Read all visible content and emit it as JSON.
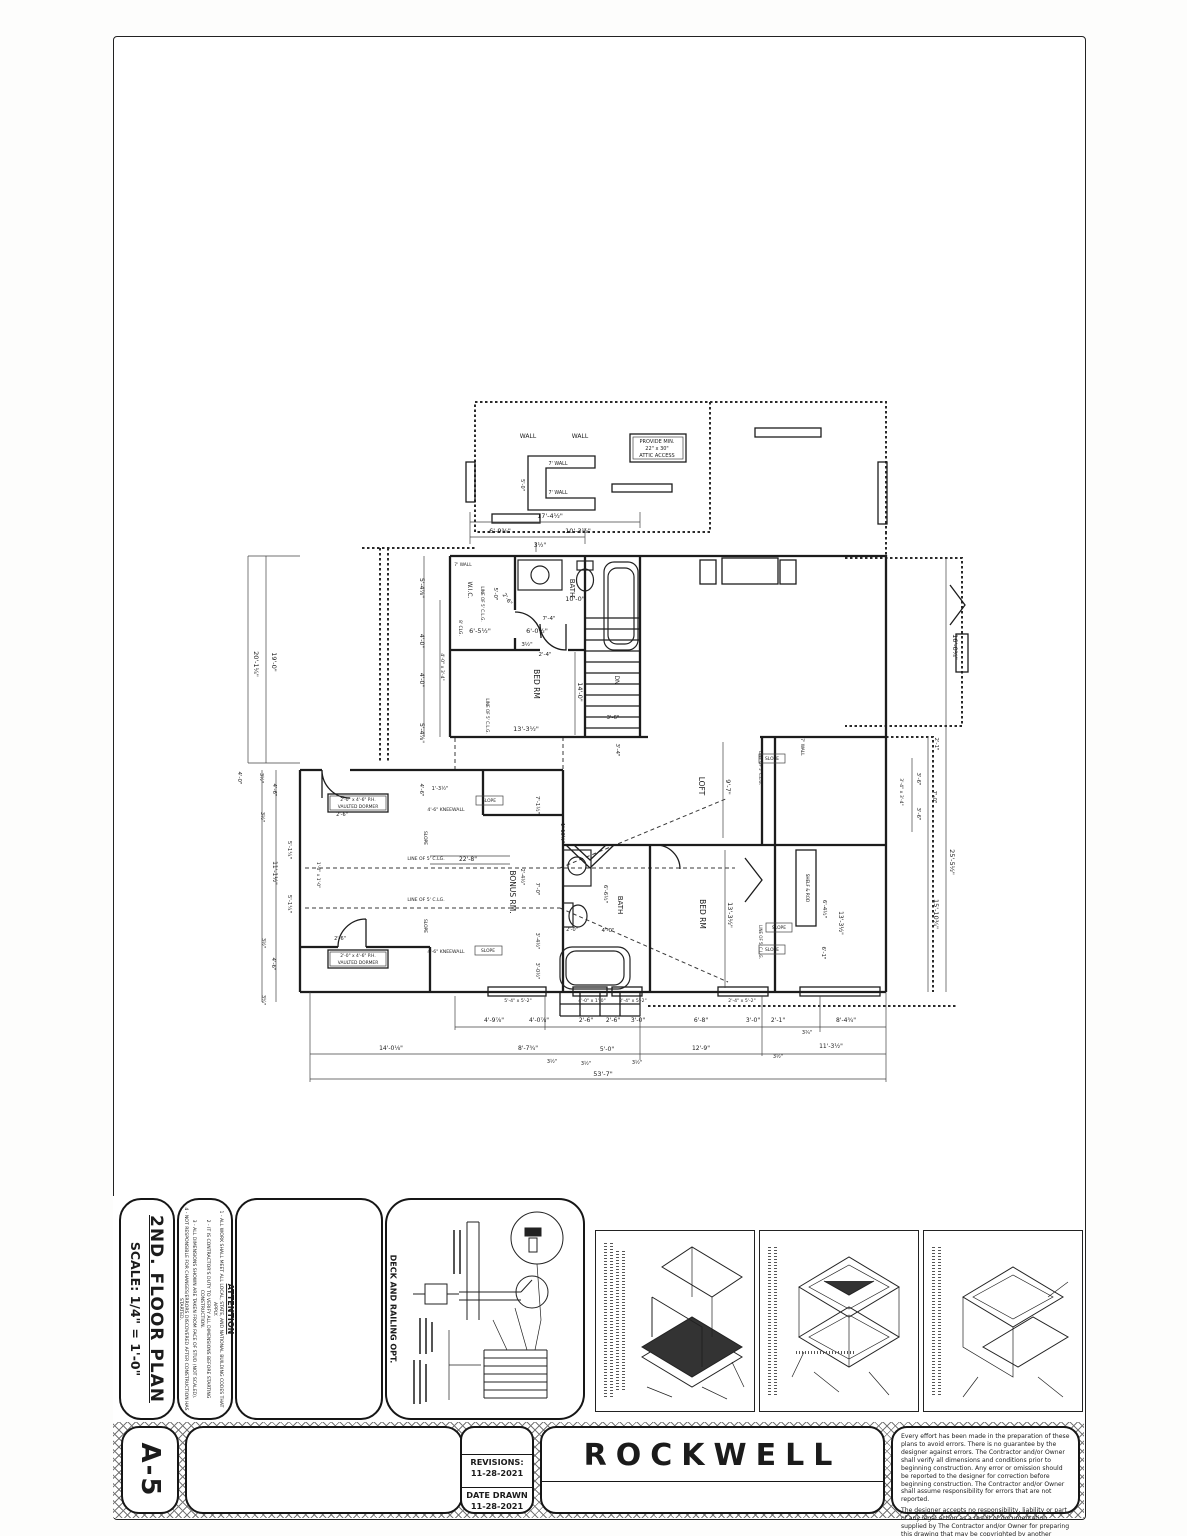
{
  "sheet": {
    "title": "2ND. FLOOR PLAN",
    "scale": "SCALE: 1/4\" = 1'-0\"",
    "sheet_number": "A-5",
    "project": "ROCKWELL",
    "revisions_label": "REVISIONS:",
    "revisions_date": "11-28-2021",
    "date_drawn_label": "DATE DRAWN",
    "date_drawn": "11-28-2021"
  },
  "attention": {
    "title": "ATTENTION",
    "notes": [
      "ALL WORK SHALL MEET ALL LOCAL, STATE, AND NATIONAL BUILDING CODES THAT APPLY.",
      "IT IS CONTRACTOR'S DUTY TO VERIFY ALL DIMENSIONS BEFORE STARTING CONSTRUCTION.",
      "ALL DIMENSIONS SHOWN ARE TAKEN FROM FACE OF STUD (NOT SCALED).",
      "NOT RESPONSIBLE FOR CHANGES/ERRORS DISCOVERED AFTER CONSTRUCTION HAS STARTED."
    ]
  },
  "deck_detail": {
    "label": "DECK AND RAILING OPT."
  },
  "disclaimer": {
    "p1": "Every effort has been made in the preparation of these plans to avoid errors. There is no guarantee by the designer against errors. The Contractor and/or Owner shall verify all dimensions and conditions prior to beginning construction. Any error or omission should be reported to the designer for correction before beginning construction. The Contractor and/or Owner shall assume responsibility for errors that are not reported.",
    "p2": "The designer accepts no responsibility, liability or part of any legal action as a result of documentation supplied by The Contractor and/or Owner for preparing this drawing that may be copyrighted by another party. All materials used to produce this drawing are to be considered to be researched by The Contractor and/or Owner for any copyright and as required by law. The Contractor and/or Owner has obtained approval from any original copyright owner(s) to use or redesign by designer."
  },
  "plan": {
    "annotations": [
      {
        "t": "WALL",
        "x": 528,
        "y": 438,
        "s": 6
      },
      {
        "t": "WALL",
        "x": 580,
        "y": 438,
        "s": 6
      },
      {
        "t": "PROVIDE MIN.",
        "x": 657,
        "y": 443,
        "s": 5
      },
      {
        "t": "22\" x 30\"",
        "x": 657,
        "y": 450,
        "s": 5
      },
      {
        "t": "ATTIC ACCESS",
        "x": 657,
        "y": 457,
        "s": 5
      },
      {
        "t": "7' WALL",
        "x": 558,
        "y": 465,
        "s": 4.8
      },
      {
        "t": "7' WALL",
        "x": 558,
        "y": 494,
        "s": 4.8
      },
      {
        "t": "5'-0\"",
        "x": 521,
        "y": 485,
        "r": 90,
        "s": 5
      },
      {
        "t": "17'-4½\"",
        "x": 550,
        "y": 518,
        "s": 6.5
      },
      {
        "t": "6'-9⅜\"",
        "x": 500,
        "y": 533,
        "s": 6.5
      },
      {
        "t": "10'-3½\"",
        "x": 578,
        "y": 533,
        "s": 6.5
      },
      {
        "t": "3½\"",
        "x": 540,
        "y": 547,
        "s": 6
      },
      {
        "t": "BATH",
        "x": 570,
        "y": 588,
        "r": 90,
        "s": 7
      },
      {
        "t": "10'-0\"",
        "x": 575,
        "y": 601,
        "s": 6.5
      },
      {
        "t": "W.I.C.",
        "x": 468,
        "y": 590,
        "r": 90,
        "s": 6
      },
      {
        "t": "7' WALL",
        "x": 463,
        "y": 566,
        "s": 4.4
      },
      {
        "t": "LINE OF 5' C.L.G.",
        "x": 481,
        "y": 604,
        "r": 90,
        "s": 4.2
      },
      {
        "t": "8' CLG.",
        "x": 459,
        "y": 628,
        "r": 90,
        "s": 4.4
      },
      {
        "t": "5'-0\"",
        "x": 494,
        "y": 594,
        "r": 90,
        "s": 5.5
      },
      {
        "t": "2'-6\"",
        "x": 506,
        "y": 600,
        "r": 55,
        "s": 5.5
      },
      {
        "t": "7'-4\"",
        "x": 549,
        "y": 620,
        "s": 5.5
      },
      {
        "t": "2'-4\"",
        "x": 545,
        "y": 656,
        "s": 5.5
      },
      {
        "t": "6'-5½\"",
        "x": 480,
        "y": 633,
        "s": 6.5
      },
      {
        "t": "6'-0½\"",
        "x": 537,
        "y": 633,
        "s": 6.5
      },
      {
        "t": "3½\"",
        "x": 527,
        "y": 646,
        "s": 5.5
      },
      {
        "t": "BED RM",
        "x": 534,
        "y": 684,
        "r": 90,
        "s": 7.5
      },
      {
        "t": "14'-0\"",
        "x": 578,
        "y": 692,
        "r": 90,
        "s": 6.5
      },
      {
        "t": "13'-3½\"",
        "x": 526,
        "y": 731,
        "s": 6.5
      },
      {
        "t": "LINE OF 5' C.L.G.",
        "x": 486,
        "y": 716,
        "r": 90,
        "s": 4.2
      },
      {
        "t": "DN",
        "x": 615,
        "y": 680,
        "r": 90,
        "s": 6
      },
      {
        "t": "3'-6\"",
        "x": 613,
        "y": 719,
        "s": 5.5
      },
      {
        "t": "3'-4\"",
        "x": 616,
        "y": 750,
        "r": 90,
        "s": 5.5
      },
      {
        "t": "20'-1¼\"",
        "x": 254,
        "y": 664,
        "r": 90,
        "s": 6.5
      },
      {
        "t": "19'-0\"",
        "x": 272,
        "y": 662,
        "r": 90,
        "s": 6.5
      },
      {
        "t": "5'-4⅞\"",
        "x": 420,
        "y": 588,
        "r": 90,
        "s": 6
      },
      {
        "t": "4'-0\"",
        "x": 420,
        "y": 641,
        "r": 90,
        "s": 6
      },
      {
        "t": "4'-0\"",
        "x": 420,
        "y": 680,
        "r": 90,
        "s": 6
      },
      {
        "t": "5'-4⅞\"",
        "x": 420,
        "y": 733,
        "r": 90,
        "s": 6
      },
      {
        "t": "4'-0\" x 3'-4\"",
        "x": 441,
        "y": 667,
        "r": 90,
        "s": 4.6
      },
      {
        "t": "4'-0\"",
        "x": 238,
        "y": 778,
        "r": 90,
        "s": 5.5
      },
      {
        "t": "3½\"",
        "x": 260,
        "y": 778,
        "r": 90,
        "s": 5
      },
      {
        "t": "4'-6\"",
        "x": 273,
        "y": 790,
        "r": 90,
        "s": 5.5
      },
      {
        "t": "1'-3½\"",
        "x": 440,
        "y": 790,
        "s": 5
      },
      {
        "t": "4'-6\"",
        "x": 420,
        "y": 790,
        "r": 90,
        "s": 5.5
      },
      {
        "t": "LOFT",
        "x": 699,
        "y": 786,
        "r": 90,
        "s": 7.5
      },
      {
        "t": "9'-7\"",
        "x": 726,
        "y": 787,
        "r": 90,
        "s": 6.5
      },
      {
        "t": "SLOPE",
        "x": 772,
        "y": 760,
        "s": 4.4
      },
      {
        "t": "LINE OF 5' C.L.G.",
        "x": 759,
        "y": 768,
        "r": 90,
        "s": 4
      },
      {
        "t": "7' WALL",
        "x": 801,
        "y": 747,
        "r": 90,
        "s": 4.4
      },
      {
        "t": "SLOPE",
        "x": 772,
        "y": 951,
        "s": 4.4
      },
      {
        "t": "LINE OF 5' C.L.G.",
        "x": 759,
        "y": 942,
        "r": 90,
        "s": 4
      },
      {
        "t": "2'-1\"",
        "x": 935,
        "y": 744,
        "r": 90,
        "s": 5.5
      },
      {
        "t": "3'-6\"",
        "x": 917,
        "y": 779,
        "r": 90,
        "s": 5.5
      },
      {
        "t": "3'-6\"",
        "x": 917,
        "y": 814,
        "r": 90,
        "s": 5.5
      },
      {
        "t": "7'-0\"",
        "x": 933,
        "y": 797,
        "r": 90,
        "s": 5.5
      },
      {
        "t": "3'-4\" x 3'-4\"",
        "x": 900,
        "y": 792,
        "r": 90,
        "s": 4.6
      },
      {
        "t": "16'-0¾\"",
        "x": 953,
        "y": 647,
        "r": 90,
        "s": 6.5
      },
      {
        "t": "25'-5½\"",
        "x": 950,
        "y": 862,
        "r": 90,
        "s": 6.5
      },
      {
        "t": "15'-10¾\"",
        "x": 934,
        "y": 914,
        "r": 90,
        "s": 6.5
      },
      {
        "t": "BED RM",
        "x": 700,
        "y": 914,
        "r": 90,
        "s": 7.5
      },
      {
        "t": "13'-3½\"",
        "x": 728,
        "y": 915,
        "r": 90,
        "s": 6.5
      },
      {
        "t": "BATH",
        "x": 618,
        "y": 905,
        "r": 90,
        "s": 7
      },
      {
        "t": "6'-6½\"",
        "x": 604,
        "y": 894,
        "r": 90,
        "s": 5.5
      },
      {
        "t": "4'-0\"",
        "x": 608,
        "y": 932,
        "s": 5.5
      },
      {
        "t": "2'-0\"",
        "x": 572,
        "y": 931,
        "s": 5
      },
      {
        "t": "SLOPE",
        "x": 779,
        "y": 929,
        "s": 4.4
      },
      {
        "t": "6'-4½\"",
        "x": 823,
        "y": 909,
        "r": 90,
        "s": 5.5
      },
      {
        "t": "13'-3½\"",
        "x": 839,
        "y": 923,
        "r": 90,
        "s": 6
      },
      {
        "t": "6'-1\"",
        "x": 822,
        "y": 953,
        "r": 90,
        "s": 5.5
      },
      {
        "t": "SHELF & ROD",
        "x": 806,
        "y": 888,
        "r": 90,
        "s": 4.2
      },
      {
        "t": "2'-0\" x 4'-6\" P.H.",
        "x": 358,
        "y": 801,
        "s": 4.4
      },
      {
        "t": "VAULTED DORMER",
        "x": 358,
        "y": 808,
        "s": 4.4
      },
      {
        "t": "2'-0\" x 4'-6\" P.H.",
        "x": 358,
        "y": 957,
        "s": 4.4
      },
      {
        "t": "VAULTED DORMER",
        "x": 358,
        "y": 964,
        "s": 4.4
      },
      {
        "t": "BONUS RM.",
        "x": 510,
        "y": 892,
        "r": 90,
        "s": 7.5
      },
      {
        "t": "LINE OF 5' C.LG.",
        "x": 426,
        "y": 860,
        "s": 4.6
      },
      {
        "t": "22'-8\"",
        "x": 468,
        "y": 861,
        "s": 6
      },
      {
        "t": "LINE OF 5' C.LG.",
        "x": 426,
        "y": 901,
        "s": 4.6
      },
      {
        "t": "SLOPE",
        "x": 424,
        "y": 926,
        "r": 90,
        "s": 4.4
      },
      {
        "t": "SLOPE",
        "x": 424,
        "y": 838,
        "r": 90,
        "s": 4.4
      },
      {
        "t": "4'-6\" KNEEWALL",
        "x": 446,
        "y": 953,
        "s": 4.6
      },
      {
        "t": "4'-6\" KNEEWALL",
        "x": 446,
        "y": 811,
        "s": 4.6
      },
      {
        "t": "SLOPE",
        "x": 489,
        "y": 802,
        "s": 4.4
      },
      {
        "t": "SLOPE",
        "x": 488,
        "y": 952,
        "s": 4.4
      },
      {
        "t": "2'-6\"",
        "x": 342,
        "y": 816,
        "s": 5
      },
      {
        "t": "2'-6\"",
        "x": 340,
        "y": 940,
        "s": 5
      },
      {
        "t": "5'-1¼\"",
        "x": 288,
        "y": 850,
        "r": 90,
        "s": 5.5
      },
      {
        "t": "5'-1¼\"",
        "x": 288,
        "y": 904,
        "r": 90,
        "s": 5.5
      },
      {
        "t": "11'-1½\"",
        "x": 273,
        "y": 873,
        "r": 90,
        "s": 6
      },
      {
        "t": "1'-0\" x 1'-0\"",
        "x": 317,
        "y": 875,
        "r": 90,
        "s": 4.4
      },
      {
        "t": "3½\"",
        "x": 261,
        "y": 817,
        "r": 90,
        "s": 5
      },
      {
        "t": "4'-6\"",
        "x": 272,
        "y": 964,
        "r": 90,
        "s": 5.5
      },
      {
        "t": "3½\"",
        "x": 262,
        "y": 943,
        "r": 90,
        "s": 5
      },
      {
        "t": "3¼\"",
        "x": 262,
        "y": 1000,
        "r": 90,
        "s": 5
      },
      {
        "t": "7'-1½\"",
        "x": 536,
        "y": 805,
        "r": 90,
        "s": 5.5
      },
      {
        "t": "1'-10½\"",
        "x": 561,
        "y": 833,
        "r": 90,
        "s": 5
      },
      {
        "t": "7'-0\"",
        "x": 536,
        "y": 889,
        "r": 90,
        "s": 5.5
      },
      {
        "t": "2'-4½\"",
        "x": 521,
        "y": 877,
        "r": 90,
        "s": 5
      },
      {
        "t": "3'-4½\"",
        "x": 536,
        "y": 941,
        "r": 90,
        "s": 5
      },
      {
        "t": "3'-0½\"",
        "x": 536,
        "y": 971,
        "r": 90,
        "s": 5
      },
      {
        "t": "5'-4\" x 5'-2\"",
        "x": 518,
        "y": 1002,
        "s": 4.6
      },
      {
        "t": "4'-0\" x 1'-0\"",
        "x": 592,
        "y": 1002,
        "s": 4.6
      },
      {
        "t": "2'-4\" x 5'-2\"",
        "x": 633,
        "y": 1002,
        "s": 4.6
      },
      {
        "t": "2'-4\" x 5'-2\"",
        "x": 742,
        "y": 1002,
        "s": 4.6
      },
      {
        "t": "4'-9⅞\"",
        "x": 494,
        "y": 1022,
        "s": 6
      },
      {
        "t": "4'-0⅞\"",
        "x": 539,
        "y": 1022,
        "s": 6
      },
      {
        "t": "2'-6\"",
        "x": 586,
        "y": 1022,
        "s": 6
      },
      {
        "t": "2'-6\"",
        "x": 613,
        "y": 1022,
        "s": 6
      },
      {
        "t": "3'-0\"",
        "x": 638,
        "y": 1022,
        "s": 6
      },
      {
        "t": "6'-8\"",
        "x": 701,
        "y": 1022,
        "s": 6
      },
      {
        "t": "3'-0\"",
        "x": 753,
        "y": 1022,
        "s": 6
      },
      {
        "t": "2'-1\"",
        "x": 778,
        "y": 1022,
        "s": 6
      },
      {
        "t": "8'-4¾\"",
        "x": 846,
        "y": 1022,
        "s": 6
      },
      {
        "t": "3¾\"",
        "x": 807,
        "y": 1034,
        "s": 5
      },
      {
        "t": "14'-0⅛\"",
        "x": 391,
        "y": 1050,
        "s": 6
      },
      {
        "t": "8'-7¾\"",
        "x": 528,
        "y": 1050,
        "s": 6
      },
      {
        "t": "3½\"",
        "x": 552,
        "y": 1063,
        "s": 5
      },
      {
        "t": "3½\"",
        "x": 586,
        "y": 1065,
        "s": 5
      },
      {
        "t": "5'-0\"",
        "x": 607,
        "y": 1051,
        "s": 6
      },
      {
        "t": "3½\"",
        "x": 637,
        "y": 1064,
        "s": 5
      },
      {
        "t": "12'-9\"",
        "x": 701,
        "y": 1050,
        "s": 6
      },
      {
        "t": "11'-3½\"",
        "x": 831,
        "y": 1048,
        "s": 6
      },
      {
        "t": "3½\"",
        "x": 778,
        "y": 1058,
        "s": 5
      },
      {
        "t": "53'-7\"",
        "x": 603,
        "y": 1076,
        "s": 6.5
      }
    ]
  }
}
